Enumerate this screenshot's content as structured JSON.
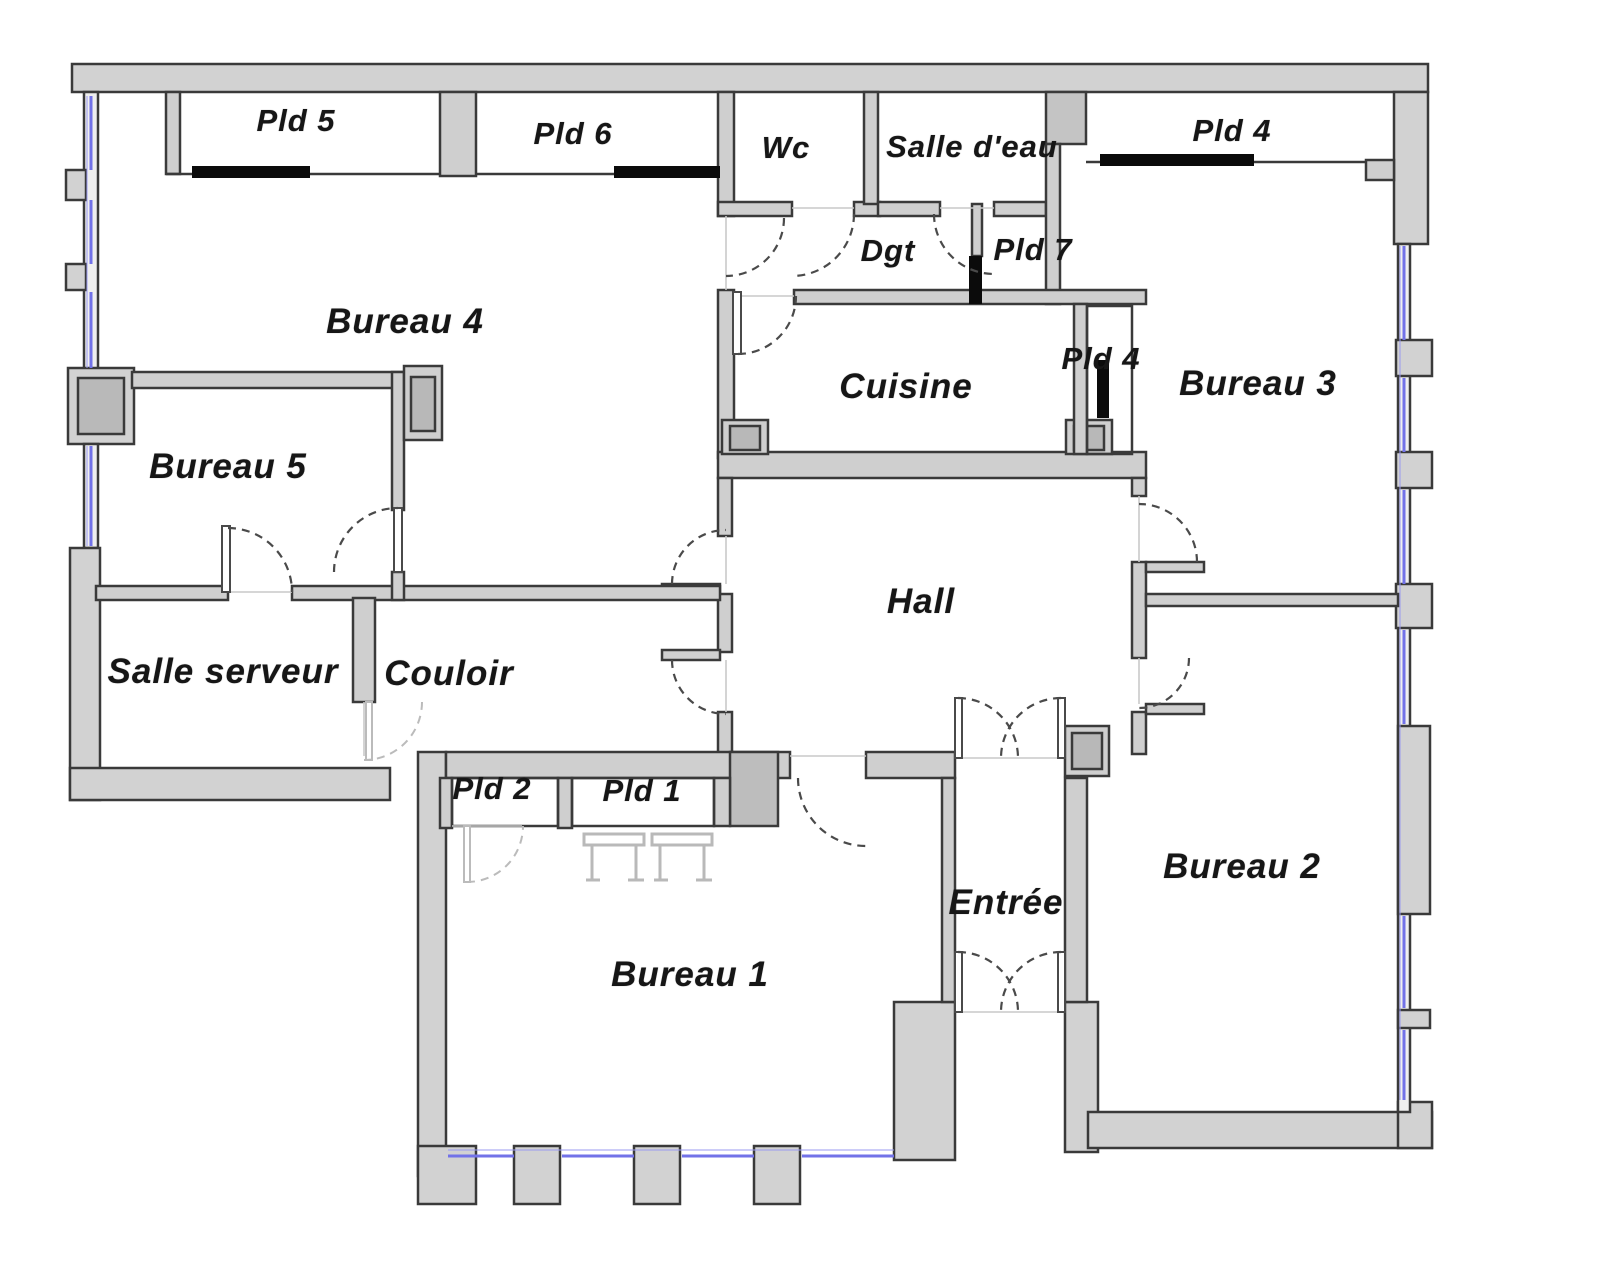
{
  "floorplan": {
    "rooms": [
      {
        "id": "pld-5",
        "label": "Pld 5"
      },
      {
        "id": "pld-6",
        "label": "Pld 6"
      },
      {
        "id": "wc",
        "label": "Wc"
      },
      {
        "id": "salle-d-eau",
        "label": "Salle d'eau"
      },
      {
        "id": "pld-4-haut",
        "label": "Pld 4"
      },
      {
        "id": "dgt",
        "label": "Dgt"
      },
      {
        "id": "pld-7",
        "label": "Pld 7"
      },
      {
        "id": "bureau-4",
        "label": "Bureau 4"
      },
      {
        "id": "cuisine",
        "label": "Cuisine"
      },
      {
        "id": "pld-4-cuisine",
        "label": "Pld 4"
      },
      {
        "id": "bureau-3",
        "label": "Bureau 3"
      },
      {
        "id": "bureau-5",
        "label": "Bureau 5"
      },
      {
        "id": "hall",
        "label": "Hall"
      },
      {
        "id": "salle-serveur",
        "label": "Salle serveur"
      },
      {
        "id": "couloir",
        "label": "Couloir"
      },
      {
        "id": "pld-2",
        "label": "Pld 2"
      },
      {
        "id": "pld-1",
        "label": "Pld 1"
      },
      {
        "id": "entree",
        "label": "Entrée"
      },
      {
        "id": "bureau-2",
        "label": "Bureau 2"
      },
      {
        "id": "bureau-1",
        "label": "Bureau 1"
      }
    ],
    "colors": {
      "wall_fill": "#d2d2d2",
      "wall_stroke": "#3a3a3a",
      "window": "#7272e8",
      "slide": "#0b0b0b",
      "bg": "#ffffff",
      "label": "#161616"
    }
  }
}
